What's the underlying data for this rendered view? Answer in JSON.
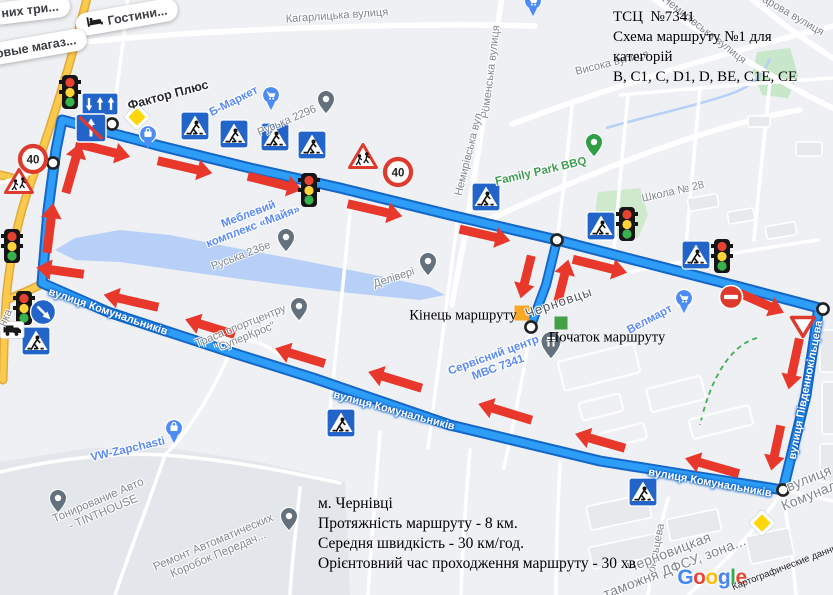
{
  "annotations": {
    "title_block": {
      "lines": [
        "ТСЦ  №7341",
        "Схема маршруту №1 для категорій",
        "В, С1, С, D1, D, ВЕ, С1Е, СЕ"
      ]
    },
    "info_block": {
      "lines": [
        "м. Чернівці",
        "Протяжність маршруту - 8 км.",
        "Середня швидкість - 30 км/год.",
        "Орієнтовний час проходження маршруту - 30 хв"
      ]
    }
  },
  "markers": {
    "end": {
      "label": "Кінець маршруту",
      "x": 522,
      "y": 313,
      "size": 15,
      "color": "#f9a825",
      "label_x": 463,
      "label_y": 316
    },
    "start": {
      "label": "Початок маршруту",
      "x": 561,
      "y": 323,
      "size": 13,
      "color": "#43a047",
      "label_x": 607,
      "label_y": 338
    }
  },
  "route": {
    "color": "#2e9df7",
    "casing": "#1467c8",
    "loop": "62,120 160,146 250,168 340,188 450,215 557,240 650,264 740,287 823,309 818,313 806,395 783,490 700,477 600,461 450,425 313,378 230,352 108,312 42,283 48,210 56,150",
    "spur": "557,240 546,285 533,320 531,327",
    "nodes": [
      [
        112,
        124
      ],
      [
        53,
        163
      ],
      [
        557,
        240
      ],
      [
        531,
        327
      ],
      [
        823,
        309
      ],
      [
        783,
        490
      ]
    ]
  },
  "arrows": {
    "color": "#e8382c",
    "items": [
      [
        103,
        150,
        14,
        56
      ],
      [
        185,
        167,
        13,
        56
      ],
      [
        275,
        183,
        14,
        56
      ],
      [
        375,
        210,
        13,
        56
      ],
      [
        485,
        235,
        13,
        52
      ],
      [
        600,
        266,
        14,
        56
      ],
      [
        762,
        303,
        24,
        48
      ],
      [
        794,
        364,
        102,
        52
      ],
      [
        776,
        448,
        102,
        46
      ],
      [
        712,
        466,
        196,
        56
      ],
      [
        600,
        441,
        196,
        52
      ],
      [
        505,
        412,
        197,
        56
      ],
      [
        395,
        380,
        197,
        56
      ],
      [
        300,
        356,
        197,
        52
      ],
      [
        210,
        327,
        197,
        52
      ],
      [
        131,
        301,
        193,
        56
      ],
      [
        60,
        271,
        188,
        48
      ],
      [
        50,
        228,
        -83,
        50
      ],
      [
        73,
        168,
        -74,
        52
      ],
      [
        526,
        277,
        104,
        44
      ],
      [
        563,
        281,
        -76,
        44
      ]
    ]
  },
  "signs": [
    {
      "t": "tl",
      "x": 70,
      "y": 92
    },
    {
      "t": "tl",
      "x": 309,
      "y": 190
    },
    {
      "t": "tl",
      "x": 627,
      "y": 224
    },
    {
      "t": "tl",
      "x": 722,
      "y": 256
    },
    {
      "t": "tl",
      "x": 12,
      "y": 246
    },
    {
      "t": "tl",
      "x": 24,
      "y": 308
    },
    {
      "t": "ped",
      "x": 195,
      "y": 126
    },
    {
      "t": "ped",
      "x": 234,
      "y": 134
    },
    {
      "t": "ped",
      "x": 275,
      "y": 137
    },
    {
      "t": "ped",
      "x": 312,
      "y": 145
    },
    {
      "t": "ped",
      "x": 486,
      "y": 197
    },
    {
      "t": "ped",
      "x": 601,
      "y": 226
    },
    {
      "t": "ped",
      "x": 696,
      "y": 255
    },
    {
      "t": "ped",
      "x": 341,
      "y": 423
    },
    {
      "t": "ped",
      "x": 643,
      "y": 492
    },
    {
      "t": "ped",
      "x": 36,
      "y": 341
    },
    {
      "t": "s40",
      "x": 33,
      "y": 159
    },
    {
      "t": "s40",
      "x": 398,
      "y": 172
    },
    {
      "t": "child",
      "x": 19,
      "y": 182
    },
    {
      "t": "child",
      "x": 363,
      "y": 157
    },
    {
      "t": "lane",
      "x": 100,
      "y": 104
    },
    {
      "t": "diamond",
      "x": 137,
      "y": 117
    },
    {
      "t": "diamond",
      "x": 762,
      "y": 523
    },
    {
      "t": "nostraight",
      "x": 91,
      "y": 128
    },
    {
      "t": "keepright",
      "x": 43,
      "y": 312
    },
    {
      "t": "truck",
      "x": 12,
      "y": 330
    },
    {
      "t": "noentry",
      "x": 731,
      "y": 297
    },
    {
      "t": "yield",
      "x": 803,
      "y": 326
    }
  ],
  "pois": [
    {
      "t": "pin-bag",
      "x": 148,
      "y": 139
    },
    {
      "t": "pin-cart",
      "x": 271,
      "y": 100
    },
    {
      "t": "pin",
      "x": 326,
      "y": 103
    },
    {
      "t": "pin-green",
      "x": 594,
      "y": 146
    },
    {
      "t": "pin",
      "x": 286,
      "y": 241
    },
    {
      "t": "pin",
      "x": 428,
      "y": 265
    },
    {
      "t": "pin",
      "x": 299,
      "y": 310
    },
    {
      "t": "pin-bank",
      "x": 551,
      "y": 346
    },
    {
      "t": "pin-cart",
      "x": 684,
      "y": 303
    },
    {
      "t": "pin-bag",
      "x": 174,
      "y": 433
    },
    {
      "t": "pin",
      "x": 58,
      "y": 502
    },
    {
      "t": "pin",
      "x": 289,
      "y": 520
    },
    {
      "t": "pin-cart",
      "x": 533,
      "y": 6
    }
  ],
  "labels": [
    {
      "text": "Кагарлицька вулиця",
      "x": 337,
      "y": 16,
      "rot": -4,
      "cls": "street"
    },
    {
      "text": "Роменська вулиця",
      "x": 491,
      "y": 72,
      "rot": -83,
      "cls": "street"
    },
    {
      "text": "Висока вулиця",
      "x": 612,
      "y": 63,
      "rot": -14,
      "cls": "street"
    },
    {
      "text": "Немирівська вулиця",
      "x": 704,
      "y": 30,
      "rot": 38,
      "cls": "street"
    },
    {
      "text": "арова вулиця",
      "x": 793,
      "y": 16,
      "rot": 30,
      "cls": "street"
    },
    {
      "text": "Немирівська вул...",
      "x": 470,
      "y": 150,
      "rot": -76,
      "cls": "street"
    },
    {
      "text": "Family Park BBQ",
      "x": 541,
      "y": 172,
      "rot": -13,
      "cls": "poi-green"
    },
    {
      "text": "Школа № 28",
      "x": 673,
      "y": 192,
      "rot": -13,
      "cls": "street"
    },
    {
      "text": "Фактор Плюс",
      "x": 168,
      "y": 95,
      "rot": -15,
      "cls": "poi-dark"
    },
    {
      "text": "Б-Маркет",
      "x": 234,
      "y": 102,
      "rot": -27,
      "cls": "poi-blue"
    },
    {
      "text": "Руська 2296",
      "x": 287,
      "y": 121,
      "rot": -23,
      "cls": "street"
    },
    {
      "lines": [
        "Меблевий",
        "комплекс «Майя»"
      ],
      "x": 251,
      "y": 221,
      "rot": -21,
      "cls": "poi-blue"
    },
    {
      "text": "Руська 236е",
      "x": 241,
      "y": 256,
      "rot": -21,
      "cls": "street"
    },
    {
      "text": "Делівері",
      "x": 394,
      "y": 278,
      "rot": -18,
      "cls": "street"
    },
    {
      "text": "Черновцы",
      "x": 559,
      "y": 303,
      "rot": -19,
      "cls": "city"
    },
    {
      "lines": [
        "Сервісний центр",
        "МВС 7341"
      ],
      "x": 496,
      "y": 362,
      "rot": -20,
      "cls": "poi-blue"
    },
    {
      "text": "Велмарт",
      "x": 650,
      "y": 320,
      "rot": -28,
      "cls": "poi-blue"
    },
    {
      "lines": [
        "Траса спортцентру",
        "\"СуперКрос\""
      ],
      "x": 243,
      "y": 332,
      "rot": -22,
      "cls": "street"
    },
    {
      "text": "вулиця Комунальників",
      "x": 108,
      "y": 312,
      "rot": 19,
      "cls": "route-street"
    },
    {
      "text": "вулиця Комунальників",
      "x": 394,
      "y": 411,
      "rot": 15,
      "cls": "route-street"
    },
    {
      "text": "вулиця Комунальників",
      "x": 710,
      "y": 483,
      "rot": 10,
      "cls": "route-street"
    },
    {
      "text": "вулиця Південнокільцева",
      "x": 806,
      "y": 390,
      "rot": -79,
      "cls": "route-street"
    },
    {
      "lines": [
        "вулиця",
        "Комунал..."
      ],
      "x": 812,
      "y": 486,
      "rot": -22,
      "cls": "street-big"
    },
    {
      "text": "нокільцева",
      "x": 656,
      "y": 551,
      "rot": -79,
      "cls": "street"
    },
    {
      "lines": [
        "Черновицкая",
        "таможня ДФСУ, зона..."
      ],
      "x": 672,
      "y": 560,
      "rot": -21,
      "cls": "street-big"
    },
    {
      "text": "VW-Zapchasti",
      "x": 128,
      "y": 450,
      "rot": -13,
      "cls": "poi-blue"
    },
    {
      "lines": [
        "Тонирование Авто",
        "- TINTHOUSE"
      ],
      "x": 101,
      "y": 507,
      "rot": -23,
      "cls": "poi-grey"
    },
    {
      "lines": [
        "Ремонт Автоматических",
        "Коробок Передач..."
      ],
      "x": 216,
      "y": 549,
      "rot": -23,
      "cls": "poi-grey"
    },
    {
      "text": "нка",
      "x": 6,
      "y": 318,
      "rot": -65,
      "cls": "street"
    }
  ],
  "pills": [
    {
      "text": "них три...",
      "x": 30,
      "y": 10,
      "rot": -7
    },
    {
      "text": "Гостини...",
      "x": 127,
      "y": 17,
      "rot": -10,
      "icon": "bed"
    },
    {
      "text": "овые магаз...",
      "x": 36,
      "y": 47,
      "rot": -10
    }
  ],
  "google_logo": {
    "letters": [
      [
        "G",
        "#4285F4"
      ],
      [
        "o",
        "#EA4335"
      ],
      [
        "o",
        "#FBBC05"
      ],
      [
        "g",
        "#4285F4"
      ],
      [
        "l",
        "#34A853"
      ],
      [
        "e",
        "#EA4335"
      ]
    ]
  },
  "attribution": "Картографические данны..."
}
